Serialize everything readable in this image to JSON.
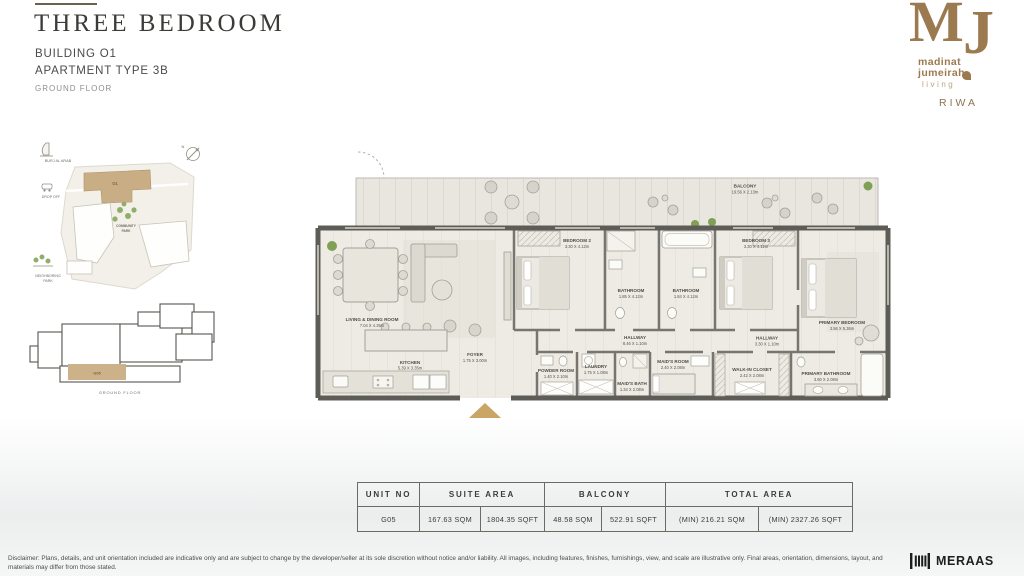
{
  "header": {
    "title": "THREE BEDROOM",
    "building": "BUILDING O1",
    "apartment_type": "APARTMENT TYPE 3B",
    "floor": "GROUND FLOOR"
  },
  "brand": {
    "monogram_m": "M",
    "monogram_j": "J",
    "name_line1": "madinat",
    "name_line2": "jumeirah",
    "name_line3": "living",
    "project": "RIWA",
    "color": "#9c7a50"
  },
  "site_map": {
    "burj_al_arab": "BURJ AL ARAB",
    "compass": "N",
    "drop_off": "DROP OFF",
    "community_park_line1": "COMMUNITY",
    "community_park_line2": "PARK",
    "neighboring_park_line1": "NEIGHBORING",
    "neighboring_park_line2": "PARK",
    "building_tag": "O1",
    "unit_tag": "G05",
    "caption": "GROUND FLOOR"
  },
  "floor_plan": {
    "entrance_color": "#c9a566",
    "rooms": [
      {
        "name": "BALCONY",
        "dims": "19.56 X 2.13m"
      },
      {
        "name": "LIVING & DINING ROOM",
        "dims": "7.04 X 4.35m"
      },
      {
        "name": "KITCHEN",
        "dims": "5.39 X 3.35m"
      },
      {
        "name": "FOYER",
        "dims": "1.75 X 3.00m"
      },
      {
        "name": "BEDROOM 2",
        "dims": "3.30 X 4.12m"
      },
      {
        "name": "BATHROOM",
        "dims": "1.85 X 4.12m"
      },
      {
        "name": "BATHROOM",
        "dims": "1.84 X 4.12m"
      },
      {
        "name": "BEDROOM 3",
        "dims": "3.30 X 4.12m"
      },
      {
        "name": "PRIMARY BEDROOM",
        "dims": "3.56 X 5.36m"
      },
      {
        "name": "HALLWAY",
        "dims": "8.46 X 1.10m"
      },
      {
        "name": "HALLWAY",
        "dims": "3.30 X 1.10m"
      },
      {
        "name": "POWDER ROOM",
        "dims": "1.40 X 2.10m"
      },
      {
        "name": "LAUNDRY",
        "dims": "1.75 X 1.08m"
      },
      {
        "name": "MAID'S BATH",
        "dims": "1.34 X 2.08m"
      },
      {
        "name": "MAID'S ROOM",
        "dims": "2.40 X 2.08m"
      },
      {
        "name": "WALK-IN CLOSET",
        "dims": "2.42 X 2.08m"
      },
      {
        "name": "PRIMARY BATHROOM",
        "dims": "3.60 X 2.08m"
      }
    ]
  },
  "area_table": {
    "headers": [
      "UNIT NO",
      "SUITE AREA",
      "BALCONY",
      "TOTAL AREA"
    ],
    "row": {
      "unit_no": "G05",
      "suite_sqm": "167.63 SQM",
      "suite_sqft": "1804.35 SQFT",
      "balcony_sqm": "48.58 SQM",
      "balcony_sqft": "522.91 SQFT",
      "total_sqm": "(MIN) 216.21 SQM",
      "total_sqft": "(MIN) 2327.26 SQFT"
    }
  },
  "footer": {
    "disclaimer": "Disclaimer: Plans, details, and unit orientation included are indicative only and are subject to change by the developer/seller at its sole discretion without notice and/or liability. All images, including features, finishes, furnishings, view, and scale are illustrative only. Final areas, orientation, dimensions, layout, and materials may differ from those stated.",
    "meraas": "MERAAS"
  }
}
